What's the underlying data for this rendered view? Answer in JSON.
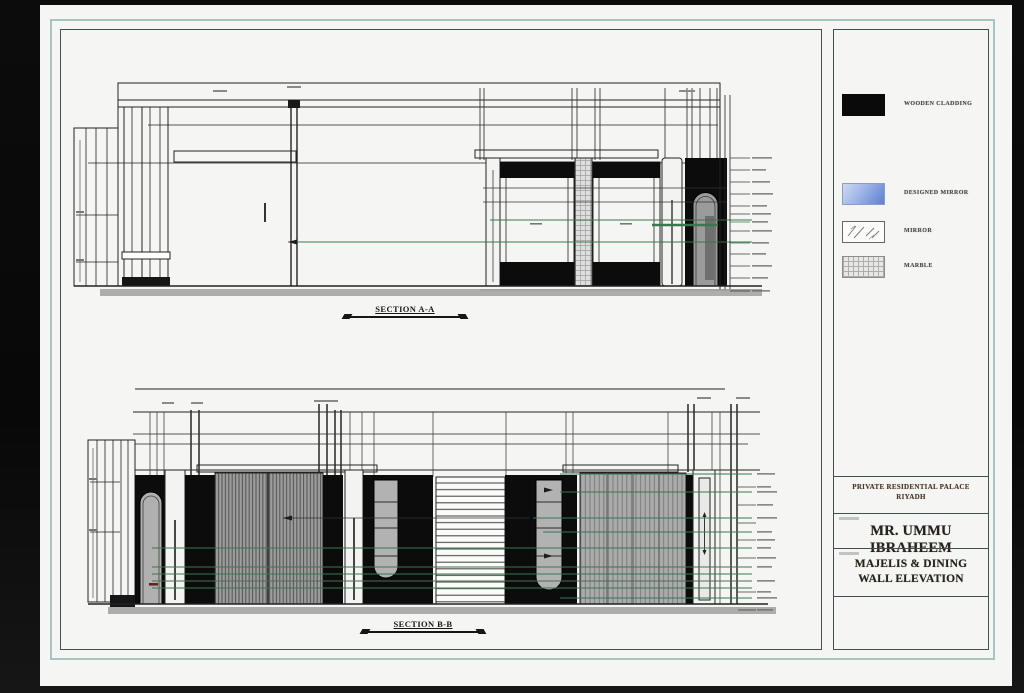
{
  "sheet": {
    "background": "#f5f6f3"
  },
  "sections": {
    "a_label": "SECTION A-A",
    "b_label": "SECTION B-B"
  },
  "legend": {
    "items": [
      {
        "name": "wooden-cladding",
        "label": "WOODEN CLADDING",
        "swatch": "black-solid"
      },
      {
        "name": "designed-mirror",
        "label": "DESIGNED MIRROR",
        "swatch": "blue-gradient"
      },
      {
        "name": "mirror",
        "label": "MIRROR",
        "swatch": "mirror-hatch"
      },
      {
        "name": "marble",
        "label": "MARBLE",
        "swatch": "grid-hatch"
      }
    ]
  },
  "title_block": {
    "project_line1": "PRIVATE RESIDENTIAL PALACE",
    "project_line2": "RIYADH",
    "client_name": "MR. UMMU IBRAHEEM",
    "drawing_title_line1": "MAJELIS & DINING",
    "drawing_title_line2": "WALL ELEVATION"
  },
  "colors": {
    "frame_teal": "#a6c4c2",
    "frame_dark": "#41504f",
    "annotation_green": "#38774a",
    "swatch_blue_start": "#cfdaf2",
    "swatch_blue_end": "#5f7fd0"
  }
}
